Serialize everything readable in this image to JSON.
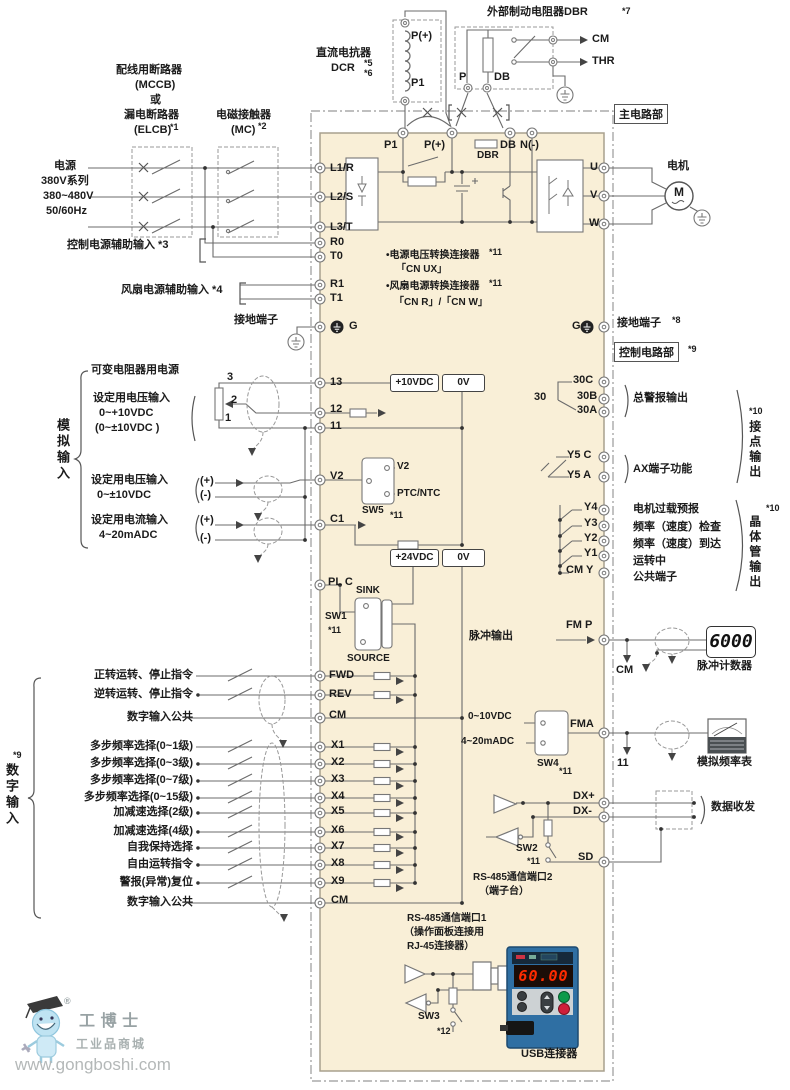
{
  "colors": {
    "panel": "#f9efd7",
    "wire": "#6b6b6b",
    "boundary": "#999999",
    "seg_red": "#ff2b00",
    "keypad_blue": "#2f6fa3",
    "run_green": "#0c9a4a",
    "stop_red": "#cf1f3a"
  },
  "tags": {
    "main": "主电路部",
    "control": "控制电路部",
    "control_note": "*9"
  },
  "source": {
    "mccb1": "配线用断路器",
    "mccb2": "(MCCB)",
    "mccb3": "或",
    "mccb4": "漏电断路器",
    "mccb5": "(ELCB)",
    "mccb_note": "*1",
    "mc1": "电磁接触器",
    "mc2": "(MC)",
    "mc_note": "*2",
    "pw1": "电源",
    "pw2": "380V系列",
    "pw3": "380~480V",
    "pw4": "50/60Hz",
    "aux": "控制电源辅助输入 *3",
    "fan": "风扇电源辅助输入 *4",
    "gnd": "接地端子"
  },
  "dcr": {
    "title": "直流电抗器",
    "name": "DCR",
    "n1": "*5",
    "n2": "*6",
    "pp": "P(+)",
    "p1": "P1"
  },
  "dbr": {
    "title": "外部制动电阻器DBR",
    "note": "*7",
    "cm": "CM",
    "thr": "THR",
    "p": "P",
    "db": "DB"
  },
  "motor": {
    "label": "电机",
    "m": "M"
  },
  "gnd_right": {
    "label": "接地端子",
    "note": "*8"
  },
  "cn": {
    "a1": "•电源电压转换连接器",
    "a1n": "*11",
    "a2": "「CN UX」",
    "b1": "•风扇电源转换连接器",
    "b1n": "*11",
    "b2": "「CN R」/「CN W」"
  },
  "term": {
    "L1": "L1/R",
    "L2": "L2/S",
    "L3": "L3/T",
    "R0": "R0",
    "T0": "T0",
    "R1": "R1",
    "T1": "T1",
    "G": "G",
    "P1": "P1",
    "PP": "P(+)",
    "DBR": "DBR",
    "DB": "DB",
    "NM": "N(-)",
    "U": "U",
    "V": "V",
    "W": "W",
    "T13": "13",
    "T12": "12",
    "T11": "11",
    "V2": "V2",
    "C1": "C1",
    "PLC": "PL C",
    "FWD": "FWD",
    "REV": "REV",
    "CM": "CM",
    "X1": "X1",
    "X2": "X2",
    "X3": "X3",
    "X4": "X4",
    "X5": "X5",
    "X6": "X6",
    "X7": "X7",
    "X8": "X8",
    "X9": "X9",
    "CM2": "CM",
    "R30C": "30C",
    "R30B": "30B",
    "R30A": "30A",
    "R30": "30",
    "Y5C": "Y5 C",
    "Y5A": "Y5 A",
    "Y4": "Y4",
    "Y3": "Y3",
    "Y2": "Y2",
    "Y1": "Y1",
    "CMY": "CM Y",
    "FMP": "FM P",
    "FMA": "FMA",
    "DXP": "DX+",
    "DXM": "DX-",
    "SD": "SD"
  },
  "boxes": {
    "v10": "+10VDC",
    "v0a": "0V",
    "v24": "+24VDC",
    "v0b": "0V"
  },
  "sw": {
    "sw5": "SW5",
    "sw5n": "*11",
    "sw5_v2": "V2",
    "sw5_ptc": "PTC/NTC",
    "sw1": "SW1",
    "sw1n": "*11",
    "sink": "SINK",
    "source": "SOURCE",
    "sw4": "SW4",
    "sw4n": "*11",
    "sw4_v": "0~10VDC",
    "sw4_i": "4~20mADC",
    "sw2": "SW2",
    "sw2n": "*11",
    "sw3": "SW3",
    "sw3n": "*12"
  },
  "analog": {
    "group": "模拟输入",
    "p3": "3",
    "p2": "2",
    "p1": "1",
    "varres": "可变电阻器用电源",
    "v1a": "设定用电压输入",
    "v1b": "0~+10VDC",
    "v1c": "(0~±10VDC )",
    "v2a": "设定用电压输入",
    "v2b": "0~±10VDC",
    "v2p": "(+)",
    "v2m": "(-)",
    "c1a": "设定用电流输入",
    "c1b": "4~20mADC",
    "c1p": "(+)",
    "c1m": "(-)"
  },
  "digital": {
    "group": "数字输入",
    "note": "*9",
    "items": [
      "正转运转、停止指令",
      "逆转运转、停止指令",
      "数字输入公共",
      "多步频率选择(0~1级)",
      "多步频率选择(0~3级)",
      "多步频率选择(0~7级)",
      "多步频率选择(0~15级)",
      "加减速选择(2级)",
      "加减速选择(4级)",
      "自我保持选择",
      "自由运转指令",
      "警报(异常)复位",
      "数字输入公共"
    ]
  },
  "out": {
    "alarm": "总警报输出",
    "ax": "AX端子功能",
    "contact": "接点输出",
    "contact_note": "*10",
    "trans": "晶体管输出",
    "trans_note": "*10",
    "t1": "电机过载预报",
    "t2": "频率（速度）检查",
    "t3": "频率（速度）到达",
    "t4": "运转中",
    "t5": "公共端子",
    "pulse": "脉冲输出",
    "counter": "脉冲计数器",
    "disp": "6000",
    "cm": "CM",
    "meter": "模拟频率表",
    "n11": "11",
    "datarx": "数据收发"
  },
  "rs": {
    "p2a": "RS-485通信端口2",
    "p2b": "（端子台）",
    "p1a": "RS-485通信端口1",
    "p1b": "（操作面板连接用",
    "p1c": "RJ-45连接器）",
    "usb": "USB连接器",
    "kdisp": "60.00"
  },
  "logo": {
    "reg": "®",
    "name": "工 博 士",
    "sub": "工业品商城",
    "url": "www.gongboshi.com"
  }
}
